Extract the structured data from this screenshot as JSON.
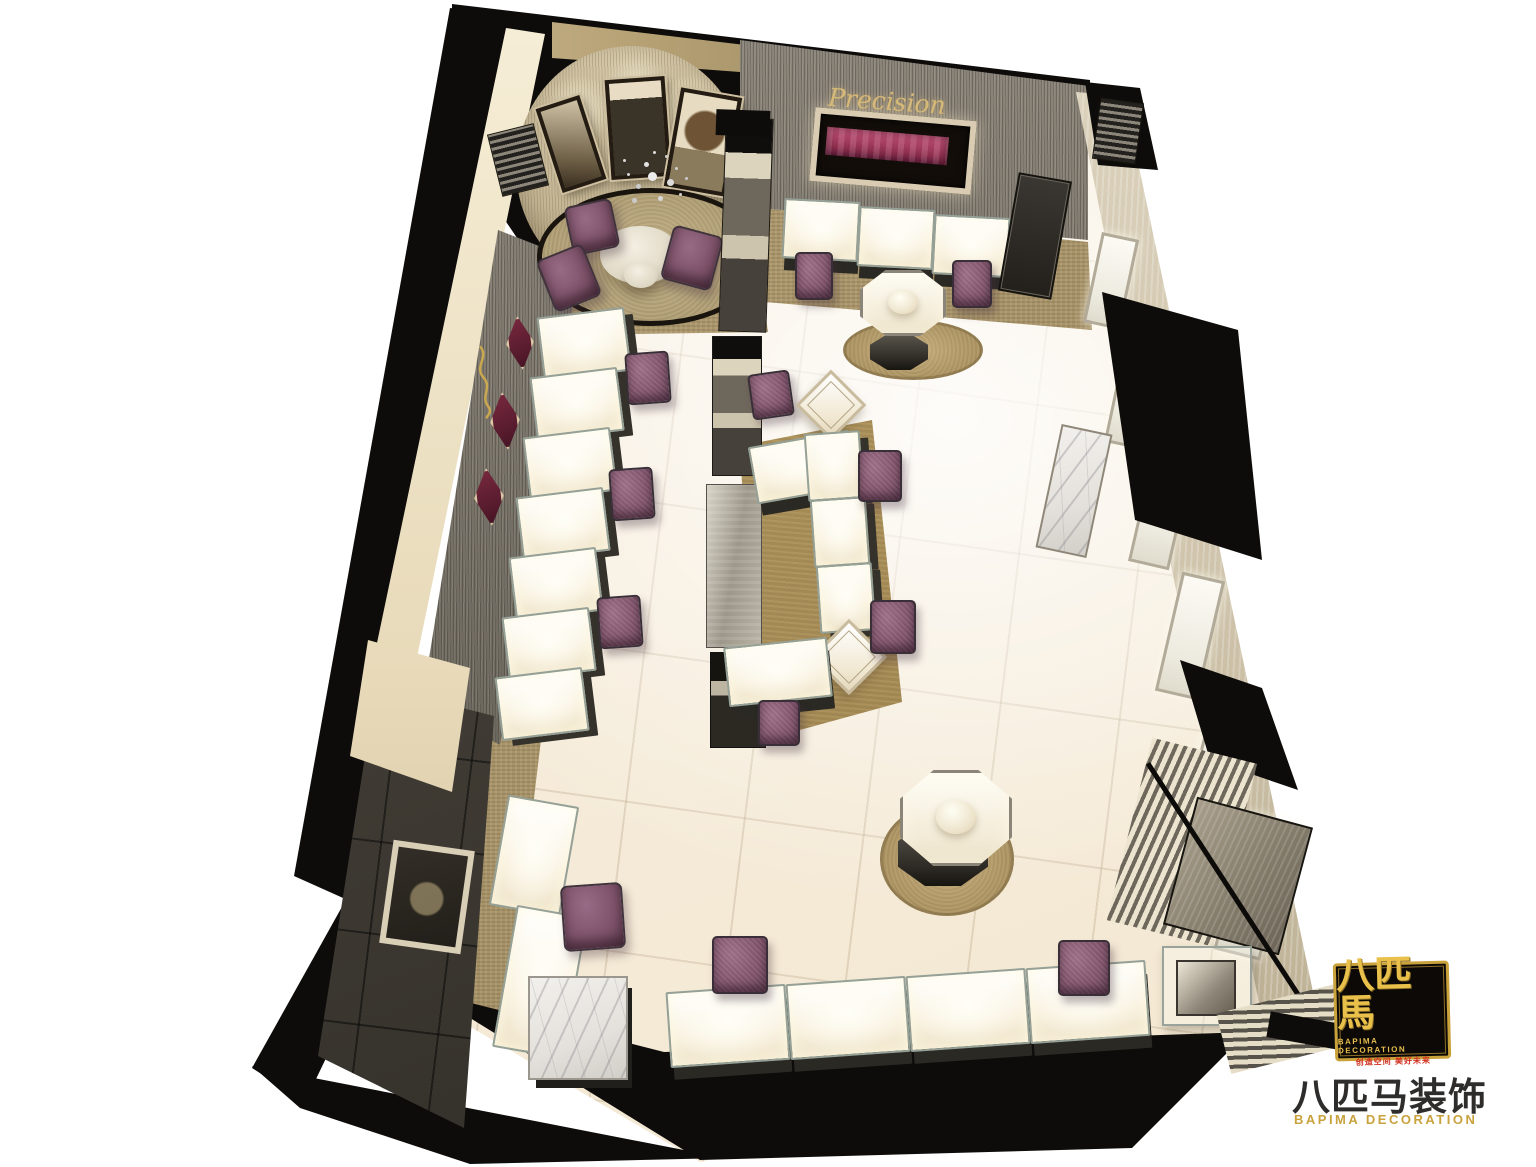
{
  "branding": {
    "showcase_wall_script": "Precision",
    "logo_badge": {
      "chinese_name": "八匹馬",
      "english_name": "BAPIMA DECORATION",
      "slogan": "创造空间  美好未来"
    },
    "watermark": {
      "chinese_name": "八匹马装饰",
      "english_name": "BAPIMA DECORATION"
    }
  },
  "palette": {
    "background": "#ffffff",
    "floor_tile": "#f7eedd",
    "carpet_tan": "#a8946a",
    "rug_gold": "#a18753",
    "wall_black": "#0d0c0a",
    "wall_gray_texture": "#817b6f",
    "wall_cream": "#d6ccb8",
    "display_white": "#faf5e8",
    "velvet_pink": "#b23f63",
    "niche_maroon": "#6d2438",
    "seat_purple": "#7c5168",
    "marble_white": "#eceae6",
    "logo_gold": "#e0b54a",
    "logo_red": "#d03020",
    "watermark_gray": "#2f2d2b"
  }
}
